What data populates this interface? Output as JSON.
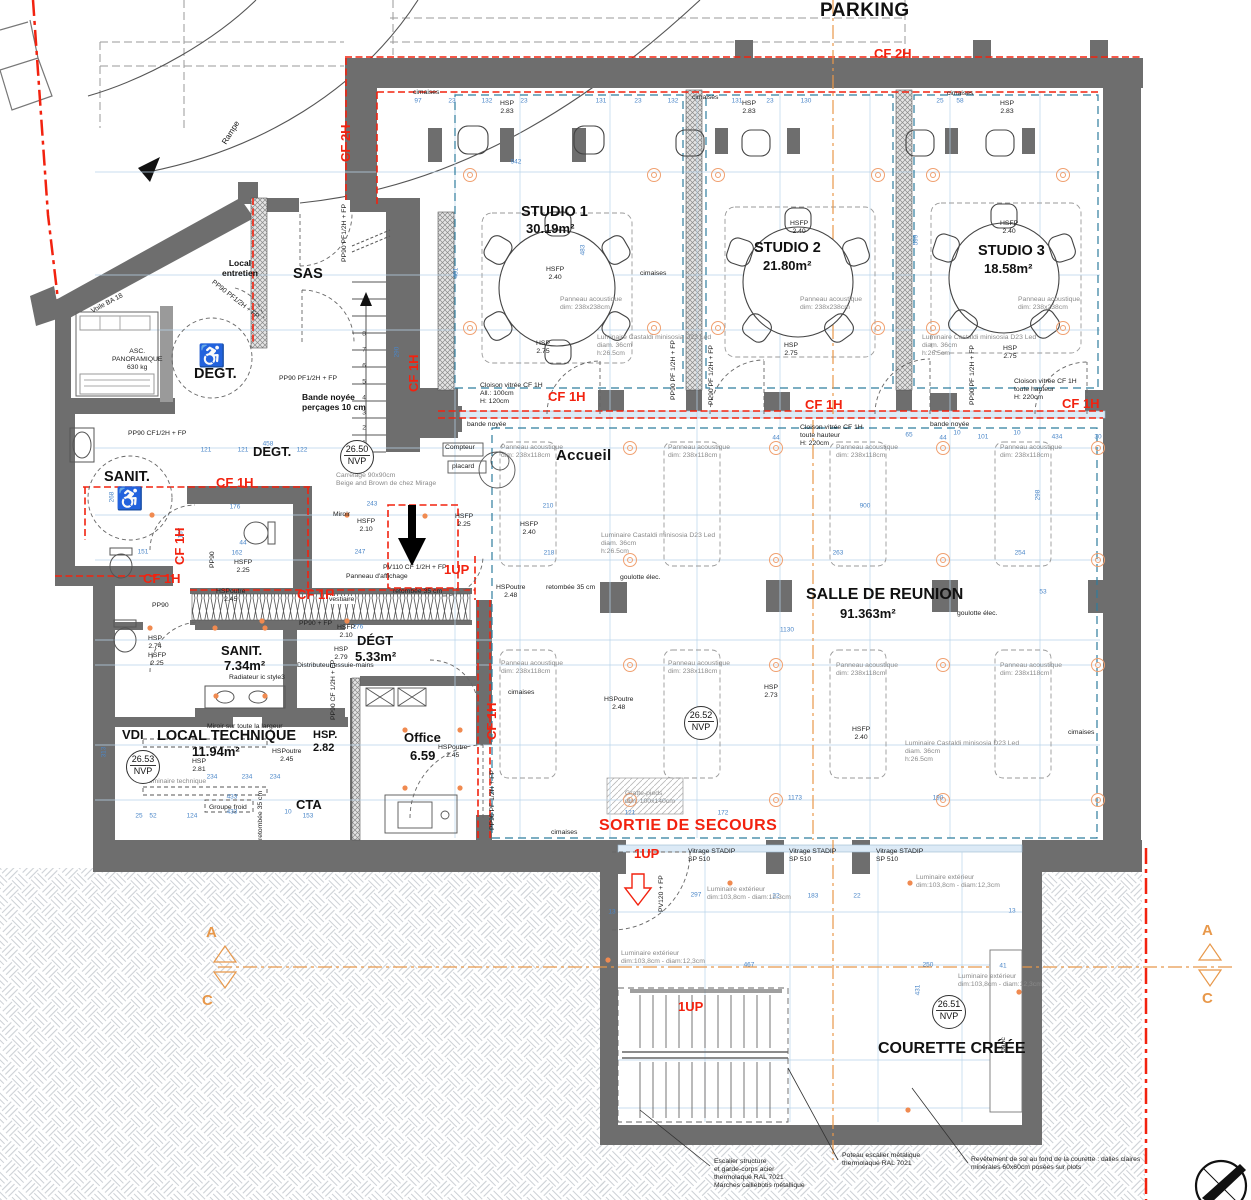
{
  "labels": {
    "parking": "PARKING",
    "rampe": "Rampe",
    "voile": "Voile BA 18",
    "cf2h": "CF 2H",
    "cf1h": "CF 1H",
    "studio1": "STUDIO 1",
    "studio1_area": "30.19m²",
    "studio2": "STUDIO 2",
    "studio2_area": "21.80m²",
    "studio3": "STUDIO 3",
    "studio3_area": "18.58m²",
    "salle": "SALLE DE REUNION",
    "salle_area": "91.363m²",
    "accueil": "Accueil",
    "sas": "SAS",
    "local_entretien": "Local\nentretien",
    "degt": "DEGT.",
    "degt2": "DÉGT",
    "degt2_area": "5.33m²",
    "sanit": "SANIT.",
    "sanit2": "SANIT.",
    "sanit2_area": "7.34m²",
    "local_technique": "LOCAL TECHNIQUE",
    "lt_area": "11.94m²",
    "vdi": "VDI",
    "cta": "CTA",
    "office": "Office",
    "office_area": "6.59",
    "courette": "COURETTE CRÉÉE",
    "banc": "banc",
    "sortie": "SORTIE DE SECOURS",
    "oneup": "1UP",
    "asc": "ASC.\nPANORAMIQUE\n630 kg",
    "nvp50": "26.50",
    "nvp51": "26.51",
    "nvp52": "26.52",
    "nvp53": "26.53",
    "nvp": "NVP",
    "hsp283": "HSP\n2.83",
    "hsfp240": "HSFP\n2.40",
    "hsp275": "HSP\n2.75",
    "hsfp225": "HSFP\n2.25",
    "hsfp210": "HSFP\n2.10",
    "hsp281": "HSP\n2.81",
    "hsp282": "HSP.\n2.82",
    "hsp274": "HSP\n2.74",
    "hsp279": "HSP\n2.79",
    "hsp273": "HSP\n2.73",
    "hspoutre245": "HSPoutre\n2.45",
    "hspoutre248": "HSPoutre\n2.48",
    "retombee": "retombée 35 cm",
    "bande_noyee": "bande noyée",
    "bande_noyee2": "Bande noyée\nperçages 10 cm",
    "cimaises": "cimaises",
    "panneau238": "Panneau acoustique\ndim: 238x238cm",
    "panneau118": "Panneau acoustique\ndim: 238x118cm",
    "luminaire": "Luminaire  Castaldi minisosia D23 Led\ndiam. 36cm\nh:26.5cm",
    "cloison1": "Cloison vitrée CF 1H\nAll.:  100cm\nH: 120cm",
    "cloison2": "Cloison vitrée CF 1H\ntoute hauteur\nH: 220cm",
    "pp90pf": "PP90 PF 1/2H + FP",
    "pp90pf2": "PP90 PF1/2H + FP",
    "pp90cf": "PP90 CF1/2H + FP",
    "pp90cf2": "PP90 CF 1/2H + FP",
    "pp90": "PP90",
    "pp90fp": "PP90 + FP",
    "pv110": "PV110 CF 1/2H + FP",
    "pv120": "PV120 + FP",
    "vitrage": "Vitrage STADIP\nSP 510",
    "lumext": "Luminaire extérieur\ndim:103,8cm - diam:12,3cm",
    "compteur": "Compteur",
    "placard": "placard",
    "goulotte": "goulotte élec.",
    "gratte": "Gratte-pieds\ndim: 100x140cm",
    "carrelage": "Carrelage 90x90cm\nBeige and Brown de chez Mirage",
    "miroir": "Miroir",
    "miroir2": "Miroir sur toute la largeur",
    "radiateur": "Radiateur ic style3",
    "distributeur": "Distributeur essuie-mains",
    "vestiaire": "vestiaire",
    "panneau_aff": "Panneau d'affichage",
    "lumtech": "Luminaire technique",
    "groupe": "Groupe froid",
    "note_escalier": "Escalier structure\net garde-corps acier\nthermolaqué RAL 7021\nMarches caillebotis métallique",
    "note_poteau": "Poteau escalier métalique\nthermolaqué RAL 7021",
    "note_sol": "Revêtement de sol au fond de la courette : dalles claires\nminérales 60x60cm posées sur plots",
    "section_a": "A",
    "section_c": "C"
  },
  "colors": {
    "wall": "#6e6e6e",
    "fire_red": "#f2220f",
    "dimension_blue": "#4a86c8",
    "section_orange": "#e8984a",
    "light_orange": "#f0a070",
    "cimaises_teal": "#2e7d9e"
  },
  "dims": [
    {
      "t": "97",
      "x": 418,
      "y": 101
    },
    {
      "t": "23",
      "x": 452,
      "y": 101
    },
    {
      "t": "132",
      "x": 487,
      "y": 101
    },
    {
      "t": "23",
      "x": 524,
      "y": 101
    },
    {
      "t": "131",
      "x": 601,
      "y": 101
    },
    {
      "t": "23",
      "x": 638,
      "y": 101
    },
    {
      "t": "132",
      "x": 673,
      "y": 101
    },
    {
      "t": "131",
      "x": 737,
      "y": 101
    },
    {
      "t": "23",
      "x": 770,
      "y": 101
    },
    {
      "t": "130",
      "x": 806,
      "y": 101
    },
    {
      "t": "25",
      "x": 940,
      "y": 101
    },
    {
      "t": "58",
      "x": 960,
      "y": 101
    },
    {
      "t": "942",
      "x": 516,
      "y": 162
    },
    {
      "t": "481",
      "x": 456,
      "y": 273,
      "r": 1
    },
    {
      "t": "483",
      "x": 583,
      "y": 250,
      "r": 1
    },
    {
      "t": "599",
      "x": 916,
      "y": 240,
      "r": 1
    },
    {
      "t": "900",
      "x": 865,
      "y": 506
    },
    {
      "t": "263",
      "x": 838,
      "y": 553
    },
    {
      "t": "254",
      "x": 1020,
      "y": 553
    },
    {
      "t": "44",
      "x": 776,
      "y": 438
    },
    {
      "t": "44",
      "x": 943,
      "y": 438
    },
    {
      "t": "10",
      "x": 957,
      "y": 433
    },
    {
      "t": "10",
      "x": 1017,
      "y": 433
    },
    {
      "t": "101",
      "x": 983,
      "y": 437
    },
    {
      "t": "434",
      "x": 1057,
      "y": 437
    },
    {
      "t": "30",
      "x": 1098,
      "y": 437
    },
    {
      "t": "65",
      "x": 909,
      "y": 435
    },
    {
      "t": "1130",
      "x": 787,
      "y": 630
    },
    {
      "t": "298",
      "x": 1038,
      "y": 495,
      "r": 1
    },
    {
      "t": "53",
      "x": 1043,
      "y": 592
    },
    {
      "t": "458",
      "x": 268,
      "y": 444
    },
    {
      "t": "121",
      "x": 206,
      "y": 450
    },
    {
      "t": "121",
      "x": 243,
      "y": 450
    },
    {
      "t": "122",
      "x": 302,
      "y": 450
    },
    {
      "t": "176",
      "x": 235,
      "y": 507
    },
    {
      "t": "243",
      "x": 372,
      "y": 504
    },
    {
      "t": "247",
      "x": 360,
      "y": 552
    },
    {
      "t": "162",
      "x": 237,
      "y": 553
    },
    {
      "t": "44",
      "x": 243,
      "y": 543
    },
    {
      "t": "151",
      "x": 143,
      "y": 552
    },
    {
      "t": "268",
      "x": 112,
      "y": 497,
      "r": 1
    },
    {
      "t": "167",
      "x": 181,
      "y": 533,
      "r": 1
    },
    {
      "t": "290",
      "x": 397,
      "y": 352,
      "r": 1
    },
    {
      "t": "210",
      "x": 548,
      "y": 506
    },
    {
      "t": "218",
      "x": 549,
      "y": 553
    },
    {
      "t": "433",
      "x": 232,
      "y": 797
    },
    {
      "t": "433",
      "x": 232,
      "y": 812
    },
    {
      "t": "234",
      "x": 212,
      "y": 777
    },
    {
      "t": "234",
      "x": 247,
      "y": 777
    },
    {
      "t": "234",
      "x": 275,
      "y": 777
    },
    {
      "t": "313",
      "x": 104,
      "y": 752,
      "r": 1
    },
    {
      "t": "25",
      "x": 139,
      "y": 816
    },
    {
      "t": "52",
      "x": 153,
      "y": 816
    },
    {
      "t": "124",
      "x": 192,
      "y": 816
    },
    {
      "t": "153",
      "x": 308,
      "y": 816
    },
    {
      "t": "10",
      "x": 288,
      "y": 812
    },
    {
      "t": "276",
      "x": 358,
      "y": 627
    },
    {
      "t": "1173",
      "x": 795,
      "y": 798
    },
    {
      "t": "190",
      "x": 938,
      "y": 798
    },
    {
      "t": "121",
      "x": 630,
      "y": 813
    },
    {
      "t": "172",
      "x": 723,
      "y": 813
    },
    {
      "t": "297",
      "x": 696,
      "y": 895
    },
    {
      "t": "22",
      "x": 776,
      "y": 896
    },
    {
      "t": "183",
      "x": 813,
      "y": 896
    },
    {
      "t": "22",
      "x": 857,
      "y": 896
    },
    {
      "t": "467",
      "x": 749,
      "y": 965
    },
    {
      "t": "250",
      "x": 928,
      "y": 965
    },
    {
      "t": "41",
      "x": 1003,
      "y": 966
    },
    {
      "t": "13",
      "x": 612,
      "y": 912
    },
    {
      "t": "13",
      "x": 1012,
      "y": 911
    },
    {
      "t": "431",
      "x": 918,
      "y": 990,
      "r": 1
    },
    {
      "t": "1",
      "x": 364,
      "y": 443,
      "c": "#444"
    },
    {
      "t": "2",
      "x": 364,
      "y": 428,
      "c": "#444"
    },
    {
      "t": "3",
      "x": 364,
      "y": 413,
      "c": "#444"
    },
    {
      "t": "4",
      "x": 364,
      "y": 398,
      "c": "#444"
    },
    {
      "t": "5",
      "x": 364,
      "y": 382,
      "c": "#444"
    },
    {
      "t": "6",
      "x": 364,
      "y": 366,
      "c": "#444"
    },
    {
      "t": "7",
      "x": 364,
      "y": 350,
      "c": "#444"
    },
    {
      "t": "8",
      "x": 364,
      "y": 334,
      "c": "#444"
    }
  ],
  "lights": [
    [
      470,
      175
    ],
    [
      654,
      175
    ],
    [
      470,
      328
    ],
    [
      654,
      328
    ],
    [
      718,
      175
    ],
    [
      878,
      175
    ],
    [
      718,
      328
    ],
    [
      878,
      328
    ],
    [
      933,
      175
    ],
    [
      1063,
      175
    ],
    [
      933,
      328
    ],
    [
      1063,
      328
    ],
    [
      630,
      448
    ],
    [
      776,
      448
    ],
    [
      943,
      448
    ],
    [
      1098,
      448
    ],
    [
      630,
      560
    ],
    [
      776,
      560
    ],
    [
      943,
      560
    ],
    [
      1098,
      560
    ],
    [
      630,
      665
    ],
    [
      776,
      665
    ],
    [
      943,
      665
    ],
    [
      1098,
      665
    ],
    [
      630,
      800
    ],
    [
      776,
      800
    ],
    [
      943,
      800
    ],
    [
      1098,
      800
    ]
  ],
  "dots": [
    [
      152,
      515
    ],
    [
      347,
      515
    ],
    [
      425,
      516
    ],
    [
      262,
      621
    ],
    [
      347,
      621
    ],
    [
      150,
      628
    ],
    [
      215,
      628
    ],
    [
      265,
      628
    ],
    [
      216,
      696
    ],
    [
      265,
      696
    ],
    [
      405,
      730
    ],
    [
      460,
      730
    ],
    [
      405,
      788
    ],
    [
      460,
      788
    ],
    [
      730,
      883
    ],
    [
      910,
      883
    ],
    [
      608,
      960
    ],
    [
      1019,
      992
    ],
    [
      908,
      1110
    ]
  ]
}
